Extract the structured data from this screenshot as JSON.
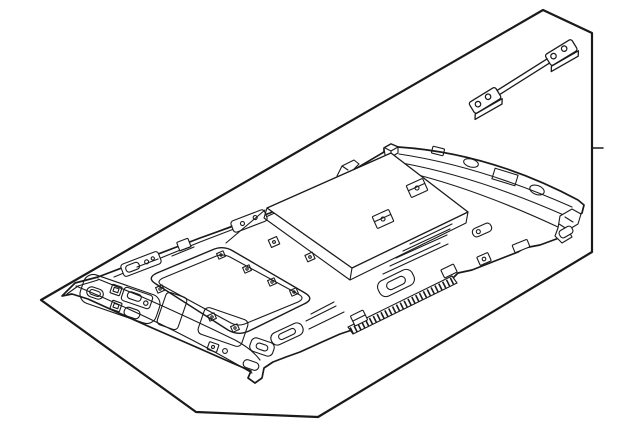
{
  "canvas": {
    "width": 640,
    "height": 429,
    "background": "#ffffff"
  },
  "colors": {
    "line": "#1a1a1a",
    "backdrop_fill": "#f6f6f6",
    "part_fill": "#ffffff"
  },
  "figure": {
    "kind": "parts-catalog-line-illustration",
    "subject": "vehicle roof headliner assembly, isometric exploded view",
    "elements": [
      {
        "name": "backdrop-panel",
        "desc": "tilted parallelogram backdrop sheet"
      },
      {
        "name": "edge-tick",
        "desc": "small tick mark on right border edge"
      },
      {
        "name": "roof-bow-strap",
        "desc": "thin reinforcement strap with bolt plates, upper right"
      },
      {
        "name": "headliner-panel",
        "desc": "headliner molding with clips and cutouts"
      },
      {
        "name": "sunroof-opening",
        "desc": "large rounded rectangular sunroof cutout"
      },
      {
        "name": "overhead-console-cutouts",
        "desc": "front console / lamp openings"
      },
      {
        "name": "ribbed-edge-strip",
        "desc": "serrated retainer strip on lower edge"
      }
    ]
  }
}
